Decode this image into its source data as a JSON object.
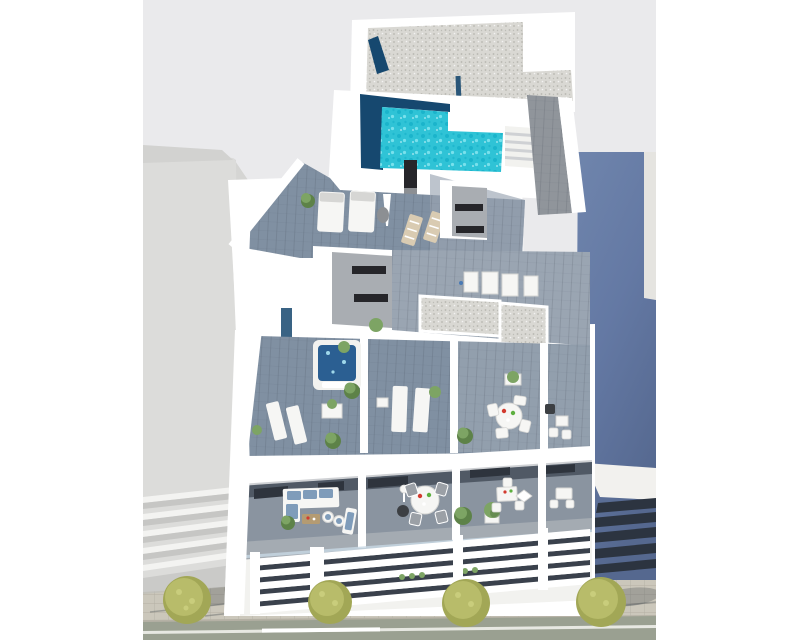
{
  "meta": {
    "title": "Aerial 3D architectural rendering of a modern white apartment building, cutaway view",
    "width": 800,
    "height": 640
  },
  "scene": {
    "type": "architectural-3d-render",
    "view": "aerial cutaway axonometric",
    "subject": "white residential building with rooftop pool, terraces and furnished apartments",
    "features": [
      "L-shaped turquoise rooftop pool",
      "gravel flat roof",
      "wood sun deck with double loungers and parasol",
      "staircase and timber walkway",
      "jacuzzi hot tub terrace",
      "terraces with sun loungers and round dining tables",
      "cutaway apartments with sofas, dining sets and kitchens",
      "white louvered street facade with hedge planting",
      "sidewalk with four trees and a road with lane line"
    ],
    "neighbors": {
      "left": "light gray building with balcony slats",
      "right": "slate blue building in shadow with dark facade louvers"
    },
    "street": {
      "tree_count": 4,
      "lane_line": true
    }
  },
  "palette": {
    "margin": "#ffffff",
    "sky": "#eaeaec",
    "white": "#ffffff",
    "off_white": "#f2f2ef",
    "wall_shade": "#d9dadc",
    "slab_edge": "#cfd1d4",
    "left_face": "#dcdcda",
    "left_roof": "#d2d2d0",
    "left_slat": "#f3f3f1",
    "left_gap": "#c6c6c4",
    "left_base": "#bcbcba",
    "blue_light": "#7389af",
    "blue_mid": "#6479a4",
    "blue_dark": "#55688f",
    "blue_lit": "#e5e4e0",
    "blue_roof": "#f2f1ee",
    "blue_edge": "#aab3c9",
    "louver_dark": "#2c3440",
    "facade_gap": "#3a414c",
    "gravel_base": "#d9d8d3",
    "gravel_dot": "#b7b6b0",
    "pool_base": "#2fc3d6",
    "pool_dark": "#12aec7",
    "pool_light": "#85e6f0",
    "navy": "#16486f",
    "deck_dark": "#8090a2",
    "deck_mid": "#9aa5b2",
    "deck_light": "#aab0b7",
    "plank": "#3c4654",
    "walkway": "#90959b",
    "core_face": "#a9adb2",
    "window_dark": "#26262a",
    "floor": "#8a94a0",
    "interior_dark": "#49525e",
    "unit_dark": "#2e343d",
    "jacuzzi": "#2b5f92",
    "sparkle": "#9fd8ea",
    "furn": "#f6f6f4",
    "furn_shadow": "#d6d6d4",
    "cushion": "#7f9cba",
    "wood": "#d9cbb2",
    "table_wood": "#b49b72",
    "lamp_gray": "#8c8f93",
    "chair_gray": "#9ba0a6",
    "dark_chair": "#3c3f43",
    "green": "#7da464",
    "green_dark": "#5d8248",
    "tree": "#b8bc6a",
    "tree_dark": "#a2a756",
    "tree_light": "#c9cd7c",
    "sidewalk": "#cbc7bb",
    "paver": "#b5b1a5",
    "road": "#9aa091",
    "road_line": "#f4f4f0",
    "shadow": "#3a4248",
    "red": "#d23b2f",
    "green_accent": "#5daf3f",
    "blue_dot": "#4a7ab5",
    "glass": "#c8d8e4"
  }
}
